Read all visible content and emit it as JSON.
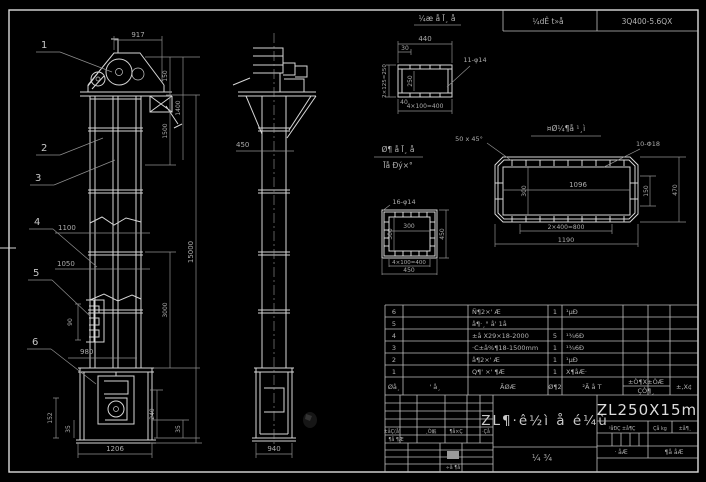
{
  "header": {
    "doc_label": "¼dÊ t»å",
    "doc_number": "3Q400-5.6QX"
  },
  "callouts": {
    "c1": "1",
    "c2": "2",
    "c3": "3",
    "c4": "4",
    "c5": "5",
    "c6": "6"
  },
  "front": {
    "top_width": "917",
    "bottom_width": "1206",
    "right": {
      "d150": "150",
      "d1400": "1400",
      "d1500": "1500",
      "d3000": "3000",
      "d240": "240",
      "d35": "35",
      "total": "15000"
    },
    "left": {
      "d1100": "1100",
      "d1050": "1050",
      "d980": "980",
      "d90": "90",
      "d152": "152",
      "d35": "35"
    }
  },
  "side": {
    "bottom_width": "940",
    "mid_dim": "450"
  },
  "detail_top": {
    "title": "¼æ å Ī¸ å",
    "width": "440",
    "offset": "30",
    "left_height": "2×125=250",
    "inner_height": "250",
    "holes": "11-φ14",
    "corner": "40",
    "bottom": "4×100=400"
  },
  "detail_mid": {
    "label_line1": "Ø¶ å Ī¸ å",
    "label_line2": "Īå Ðý×°",
    "holes": "16-φ14",
    "inner_width": "300",
    "inner_height": "300",
    "right_height": "450",
    "bottom1": "4×100=400",
    "bottom2": "450"
  },
  "detail_right": {
    "title": "¤Ø¼¶å ¹¸ì",
    "chamfer": "50 x 45°",
    "holes": "10-Φ18",
    "inner_width": "1096",
    "inner_height": "300",
    "right1": "150",
    "right2": "470",
    "bottom1": "2×400=800",
    "bottom2": "1190"
  },
  "parts_table": {
    "header": {
      "no": "Øå¸",
      "code": "' å¸",
      "name": "ÃØÆ",
      "qty": "Ø¶2",
      "material": "²Ã å T",
      "weight_top": "±Ò¶X±ÒÆ",
      "weight_bottom": "ÇÒ¶¸",
      "remark": "±,X¢"
    },
    "rows": [
      {
        "no": "6",
        "name": "Ñ¶2×' Æ",
        "qty": "1",
        "material": "¹µÐ"
      },
      {
        "no": "5",
        "name": "å¶·¸° å' 1å",
        "qty": "",
        "material": ""
      },
      {
        "no": "4",
        "name": "±å X29×18-2000",
        "qty": "5",
        "material": "¹¾6Ð"
      },
      {
        "no": "3",
        "name": "·C±å%¶18-1500mm",
        "qty": "1",
        "material": "¹¾6Ð"
      },
      {
        "no": "2",
        "name": "å¶2×' Æ",
        "qty": "1",
        "material": "¹µÐ"
      },
      {
        "no": "1",
        "name": "Q¶' ×' ¶Æ",
        "qty": "1",
        "material": "X¶åÆ·"
      }
    ]
  },
  "title_block": {
    "rev_cols": [
      "±åÇ(å'",
      "¸Ò嶯",
      "¶å×Ç",
      "·Çå"
    ],
    "rev_row2": "¶å ¶Æ",
    "stamp_label": "÷å ¶å",
    "drawing_title": "ZL¶·ê½ì å é¼ù",
    "sheet_chars": "¼    ¾",
    "model": "ZL250X15m",
    "stage_cols": [
      "³åÐÇ ±å¶Ç",
      "Çå kg",
      "±å¶¸"
    ],
    "sheet_left": "· åÆ",
    "sheet_right": "¶å åÆ"
  },
  "colors": {
    "background": "#000000",
    "line": "#d6d6d6",
    "dim": "#9a9a9a",
    "text": "#b0b0b0",
    "bright": "#e0e0e0"
  }
}
